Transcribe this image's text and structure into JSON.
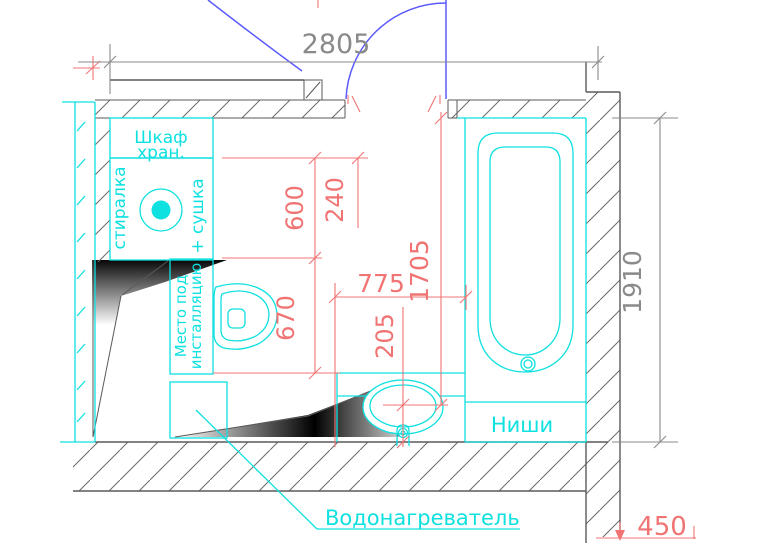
{
  "drawing": {
    "dims": {
      "top": "2805",
      "right": "1910",
      "d600": "600",
      "d240": "240",
      "d775": "775",
      "d1705": "1705",
      "d670": "670",
      "d205": "205",
      "d450": "450"
    },
    "labels": {
      "cabinet1": "Шкаф",
      "cabinet2": "хран.",
      "washer": "стиралка",
      "dryer": "+ сушка",
      "install1": "Место под",
      "install2": "инсталляцию",
      "niches": "Ниши",
      "heater": "Водонагреватель"
    },
    "colors": {
      "background": "#ffffff",
      "fixture": "#0fe0e0",
      "dim-red": "#f07474",
      "wall": "#5a5a5a",
      "dim-gray": "#8a8a8a",
      "door-blue": "#5a5aff",
      "shadow-dark": "#000000"
    }
  }
}
